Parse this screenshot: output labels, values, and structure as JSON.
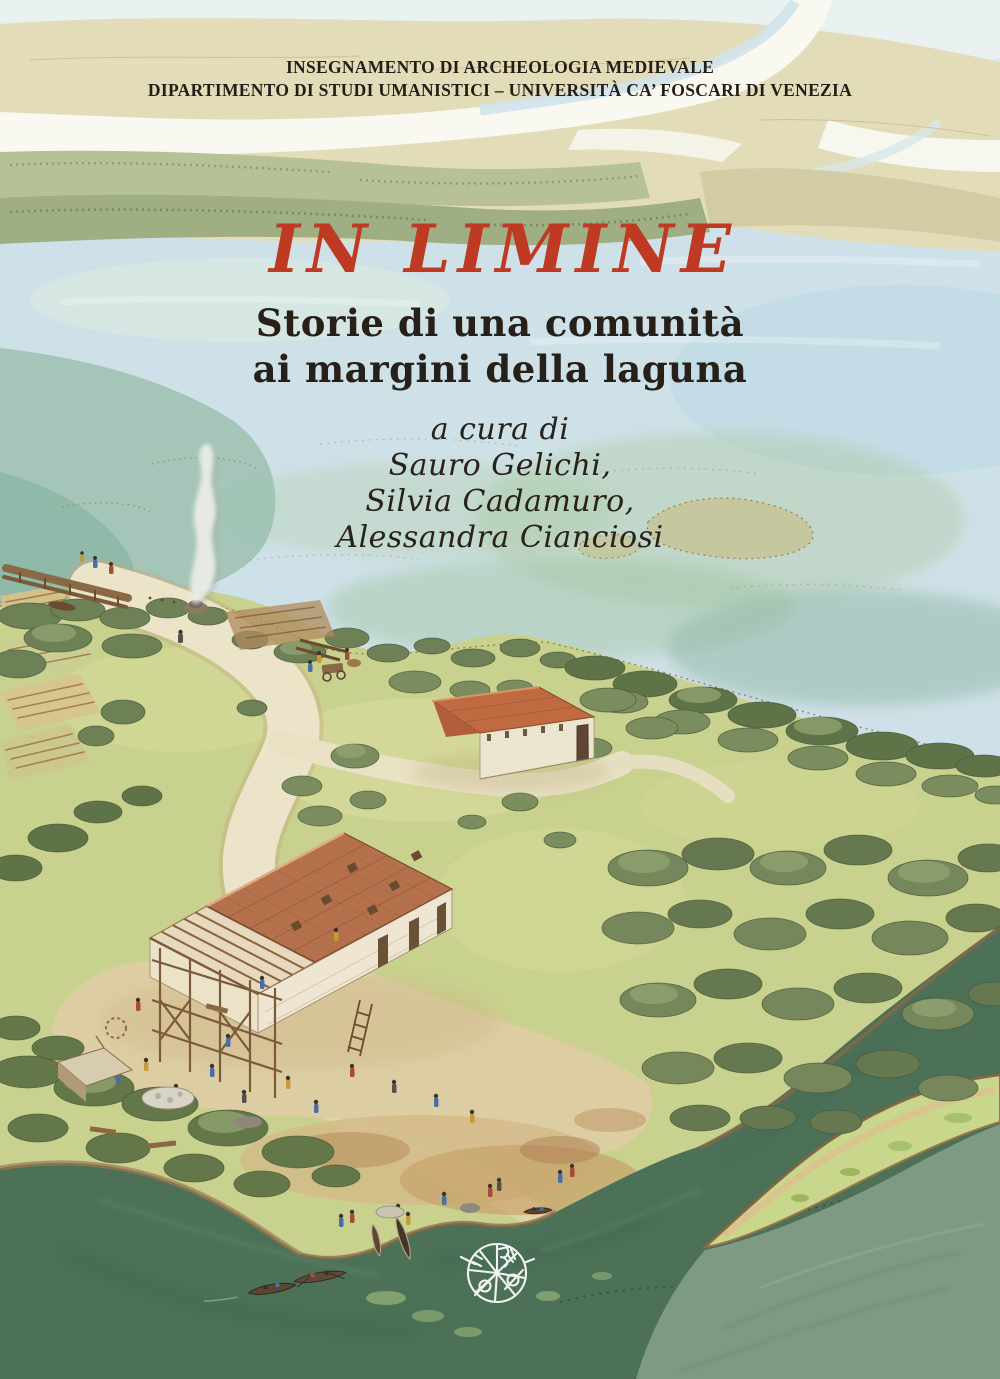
{
  "cover": {
    "affiliation_line1": "INSEGNAMENTO DI ARCHEOLOGIA MEDIEVALE",
    "affiliation_line2": "DIPARTIMENTO DI STUDI UMANISTICI – UNIVERSITÀ CA’ FOSCARI DI VENEZIA",
    "title": "IN LIMINE",
    "subtitle_line1": "Storie di una comunità",
    "subtitle_line2": "ai margini della laguna",
    "edited_by_label": "a cura di",
    "editors": [
      "Sauro Gelichi,",
      "Silvia Cadamuro,",
      "Alessandra Cianciosi"
    ],
    "logo_icon": "publisher-mark-icon",
    "colors": {
      "title_red": "#bf3a22",
      "text_dark": "#241d15",
      "lagoon_blue": "#cfe1e8",
      "distant_land_beige": "#e3dcb9",
      "island_grass_green": "#c9d18e",
      "river_dark_green": "#4d7157",
      "sage_water_green": "#7f9a84",
      "roof_terracotta": "#b5714c",
      "wall_cream": "#eee6d2"
    }
  }
}
